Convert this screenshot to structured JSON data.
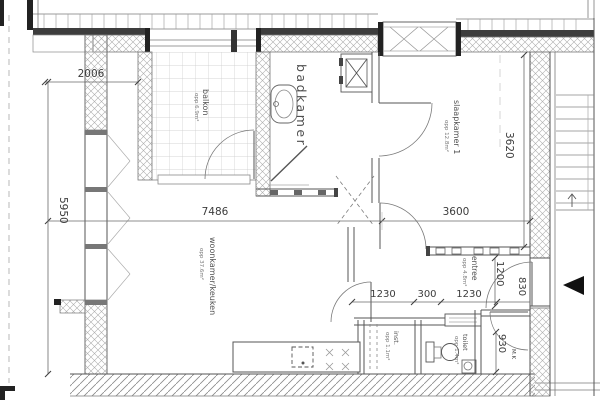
{
  "plan": {
    "rooms": {
      "balkon": {
        "name": "balkon",
        "area": "opp 6.9m²"
      },
      "badkamer": {
        "name": "badkamer"
      },
      "slaapkamer1": {
        "name": "slaapkamer 1",
        "area": "opp 12.8m²"
      },
      "woonkamer": {
        "name": "woonkamer/keuken",
        "area": "opp 37.6m²"
      },
      "entree": {
        "name": "entree",
        "area": "opp 4.8m²"
      },
      "installatie": {
        "name": "inst.",
        "area": "opp 1.1m²"
      },
      "toilet": {
        "name": "toilet",
        "area": "opp 1.4m²"
      },
      "meterkast": {
        "name": "M.K"
      }
    },
    "dimensions": {
      "d2006": "2006",
      "d7486": "7486",
      "d5950": "5950",
      "d3600": "3600",
      "d3620": "3620",
      "d1230a": "1230",
      "d300": "300",
      "d1230b": "1230",
      "d1200": "1200",
      "d830": "830",
      "d930": "930"
    },
    "colors": {
      "paper": "#ffffff",
      "line": "#555555",
      "hatch": "#adadad",
      "dark": "#222222"
    }
  }
}
